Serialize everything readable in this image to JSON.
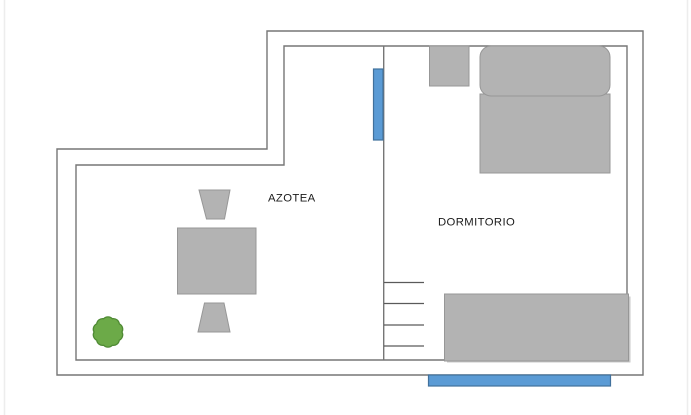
{
  "floorplan": {
    "rooms": [
      {
        "name": "azotea",
        "label": "AZOTEA"
      },
      {
        "name": "dormitorio",
        "label": "DORMITORIO"
      }
    ],
    "furniture": [
      "dining-table",
      "chair",
      "chair",
      "plant",
      "nightstand",
      "double-bed",
      "wardrobe",
      "stairs"
    ],
    "windows": [
      "window-vertical-divider-wall",
      "window-bottom-wall"
    ],
    "stairs_step_count": 4,
    "colors": {
      "wall_line": "#767676",
      "stair_line": "#5a5a5a",
      "furniture_fill": "#b3b3b3",
      "furniture_stroke": "#979797",
      "shadow": "#9c9c9c",
      "window_fill": "#5b9bd5",
      "window_stroke": "#41719c",
      "plant_fill": "#6caa48",
      "plant_stroke": "#4f8a34",
      "label_text": "#1a1a1a",
      "page_edge": "#ededed"
    }
  }
}
